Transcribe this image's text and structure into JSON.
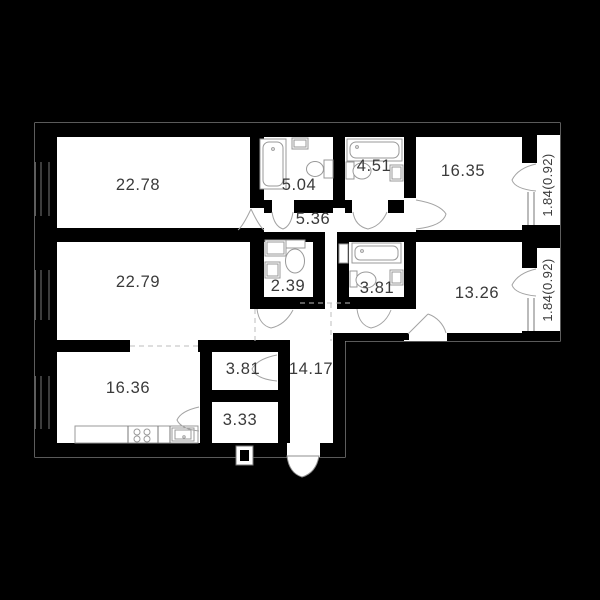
{
  "plan": {
    "type": "apartment-floor-plan",
    "rooms": [
      {
        "id": "living-room-1",
        "area": "22.78"
      },
      {
        "id": "living-room-2",
        "area": "22.79"
      },
      {
        "id": "kitchen",
        "area": "16.36"
      },
      {
        "id": "bathroom-1",
        "area": "5.04"
      },
      {
        "id": "bathroom-2",
        "area": "4.51"
      },
      {
        "id": "bedroom-1",
        "area": "16.35"
      },
      {
        "id": "corridor",
        "area": "5.36"
      },
      {
        "id": "wc",
        "area": "2.39"
      },
      {
        "id": "bathroom-3",
        "area": "3.81"
      },
      {
        "id": "bedroom-2",
        "area": "13.26"
      },
      {
        "id": "storage",
        "area": "3.81"
      },
      {
        "id": "hallway",
        "area": "14.17"
      },
      {
        "id": "pantry",
        "area": "3.33"
      }
    ],
    "balconies": [
      {
        "id": "balcony-top",
        "label": "1.84(0.92)"
      },
      {
        "id": "balcony-bottom",
        "label": "1.84(0.92)"
      }
    ],
    "colors": {
      "background": "#000000",
      "walls": "#000000",
      "floor": "#ffffff",
      "fixtures": "#999999",
      "text": "#3a3a3a",
      "outline": "#8f8f8f"
    }
  }
}
